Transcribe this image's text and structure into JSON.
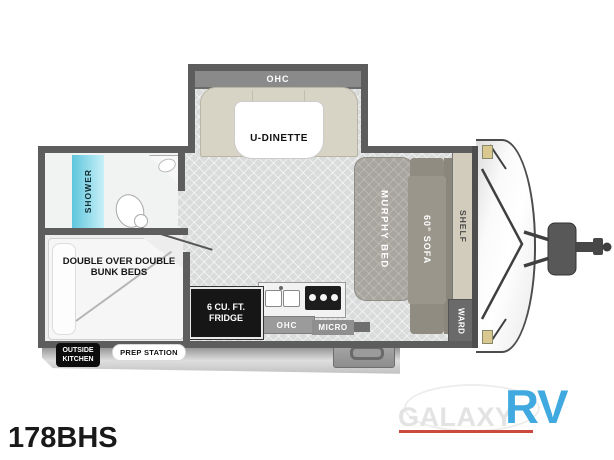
{
  "model_number": "178BHS",
  "plan": {
    "dinette_ohc": "OHC",
    "dinette": "U-DINETTE",
    "shower": "SHOWER",
    "murphy_bed": "MURPHY BED",
    "sofa": "60\" SOFA",
    "shelf": "SHELF",
    "ward": "WARD",
    "bunks": "DOUBLE OVER DOUBLE BUNK BEDS",
    "fridge": "6 CU. FT. FRIDGE",
    "kitchen_ohc": "OHC",
    "micro": "MICRO",
    "outside_kitchen": "OUTSIDE KITCHEN",
    "prep_station": "PREP STATION"
  },
  "logo": {
    "brand": "GALAXY",
    "suffix": "RV"
  },
  "colors": {
    "rv_blue": "#3fa9e0",
    "underline_red": "#cb4a3e",
    "shower_cyan": "#5fc6dd",
    "wall_gray": "#5d5d5d",
    "dinette_beige": "#d7d3c5"
  }
}
